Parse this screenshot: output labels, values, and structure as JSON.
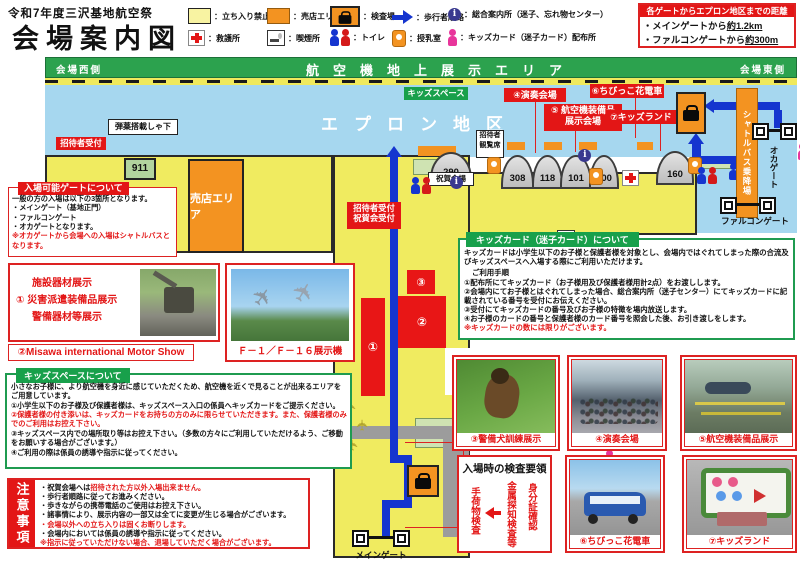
{
  "header": {
    "title_small": "令和7年度三沢基地航空祭",
    "title_large": "会場案内図",
    "legend": [
      {
        "label": "：立ち入り禁止"
      },
      {
        "label": "：売店エリア"
      },
      {
        "label": "：検査場"
      },
      {
        "label": "：歩行者順路"
      },
      {
        "label": "：総合案内所（迷子、忘れ物センター）"
      },
      {
        "label": "：救護所"
      },
      {
        "label": "：喫煙所"
      },
      {
        "label": "：トイレ"
      },
      {
        "label": "：授乳室"
      },
      {
        "label": "：キッズカード（迷子カード）配布所"
      }
    ],
    "distance": {
      "title": "各ゲートからエプロン地区までの距離",
      "line1_pre": "・メインゲートから",
      "line1_val": "約1.2km",
      "line2_pre": "・ファルコンゲートから",
      "line2_val": "約300m"
    }
  },
  "map": {
    "banner_left": "会場西側",
    "banner_center": "航空機地上展示エリア",
    "banner_right": "会場東側",
    "apron": "エプロン地区",
    "kids_space": "キッズスペース",
    "ammo_shed": "弾薬搭載しゃ下",
    "invited_reception": "招待者受付",
    "bldg_911": "911",
    "shop_area": "売店エリア",
    "label_concert": "④演奏会場",
    "label_equip_1": "⑤ 航空機装備品",
    "label_equip_2": "展示会場",
    "label_train": "⑥ちびっこ花電車",
    "label_kidsland": "⑦キッズランド",
    "invited_seats_1": "招待者",
    "invited_seats_2": "観覧席",
    "bldg_290": "290",
    "bldg_308": "308",
    "bldg_118": "118",
    "bldg_101": "101",
    "bldg_400": "400",
    "bldg_160": "160",
    "celebration_venue": "祝賀会場",
    "reception2_1": "招待者受付",
    "reception2_2": "祝賀会受付",
    "zone1": "①",
    "zone2": "②",
    "zone3": "③",
    "gate_main": "メインゲート",
    "gate_falcon": "ファルコンゲート",
    "gate_oka": "オカゲート",
    "shuttle": "シャトルバス乗降場"
  },
  "gate_info": {
    "title": "入場可能ゲートについて",
    "line1": "一般の方の入場は以下の3箇所となります。",
    "line2": "・メインゲート（基地正門）",
    "line3": "・ファルコンゲート",
    "line4": "・オカゲートとなります。",
    "note": "※オカゲートから会場への入場はシャトルバスとなります。"
  },
  "facility": {
    "line1": "施設器材展示",
    "line2": "① 災害派遣装備品展示",
    "line3": "警備器材等展示"
  },
  "motor_show": {
    "label": "②Misawa international Motor Show"
  },
  "f16": {
    "caption": "Ｆ－１／Ｆ－１６展示機"
  },
  "kids_space_box": {
    "title": "キッズスペースについて",
    "line1": "小さなお子様に、より航空機を身近に感じていただくため、航空機を近くで見ることが出来るエリアをご用意しています。",
    "line2": "①小学生以下のお子様及び保護者様は、キッズスペース入口の係員へキッズカードをご提示ください。",
    "line3": "②保護者様の付き添いは、キッズカードをお持ちの方のみに限らせていただきます。また、保護者様のみでのご利用はお控え下さい。",
    "line4": "③キッズスペース内での場所取り等はお控え下さい。（多数の方々にご利用していただけるよう、ご移動をお願いする場合がございます。）",
    "line5": "④ご利用の際は係員の誘導や指示に従ってください。"
  },
  "notes": {
    "title": "注意事項",
    "line1_black": "・祝賀会場へは",
    "line1_red": "招待された方以外入場出来ません。",
    "line2": "・歩行者順路に従ってお進みください。",
    "line3": "・歩きながらの携帯電話のご使用はお控え下さい。",
    "line4": "・諸事情により、展示内容の一部又は全てに変更が生じる場合がございます。",
    "line5": "・会場以外への立ち入りは固くお断りします。",
    "line6": "・会場内においては係員の誘導や指示に従ってください。",
    "line7": "※指示に従っていただけない場合、退場していただく場合がございます。"
  },
  "kids_card": {
    "title": "キッズカード（迷子カード）について",
    "intro": "キッズカードは小学生以下のお子様と保護者様を対象とし、会場内ではぐれてしまった際の合流及びキッズスペースへ入場する際にご利用いただけます。",
    "subtitle": "ご利用手順",
    "step1": "①配布所にてキッズカード（お子様用及び保護者様用計2点）をお渡しします。",
    "step2": "②会場内にてお子様とはぐれてしまった場合、総合案内所（迷子センター）にてキッズカードに記載されている番号を受付にお伝えください。",
    "step3": "③受付にてキッズカードの番号及びお子様の特徴を場内放送します。",
    "step4": "④お子様のカードの番号と保護者様のカード番号を照会した後、お引き渡しをします。",
    "note": "※キッズカードの数には限りがございます。"
  },
  "inspection": {
    "title": "入場時の検査要領",
    "step_right": "身分証確認",
    "step_mid": "金属探知検査等",
    "step_left": "手荷物検査"
  },
  "photos": {
    "dog": "③警備犬訓練展示",
    "concert": "④演奏会場",
    "equipment": "⑤航空機装備品展示",
    "train": "⑥ちびっこ花電車",
    "kidsland": "⑦キッズランド"
  },
  "colors": {
    "accent_red": "#e31616",
    "map_yellow": "#f0eb60",
    "orange": "#f39321",
    "route_blue": "#1535cf",
    "apron_blue": "#a6d7ef",
    "green": "#18a04b",
    "pink": "#e8359b"
  }
}
